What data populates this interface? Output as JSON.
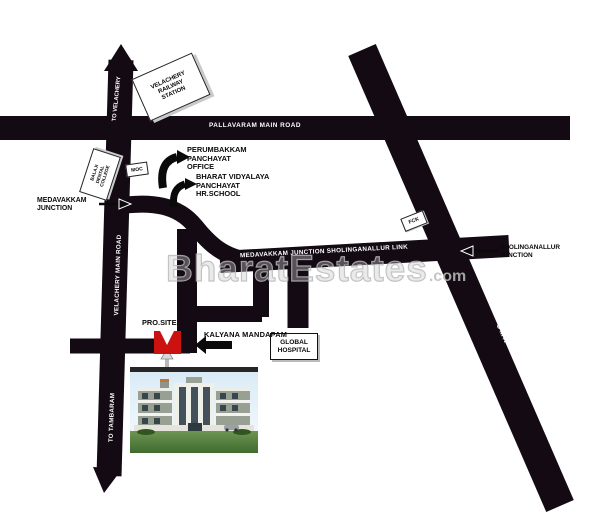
{
  "map": {
    "watermark": {
      "name": "BharatEstates",
      "suffix": ".com"
    },
    "road_labels": {
      "pallavaram": "PALLAVARAM MAIN ROAD",
      "to_velachery": "TO VELACHERY",
      "velachery_main": "VELACHERY MAIN ROAD",
      "to_tambaram": "TO TAMBARAM",
      "link_road": "MEDAVAKKAM JUNCTION SHOLINGANALLUR LINK",
      "omr": "OMR"
    },
    "landmarks": {
      "railway_station": {
        "line1": "VELACHERY",
        "line2": "RAILWAY",
        "line3": "STATION"
      },
      "college": {
        "line1": "BALAJI",
        "line2": "DENTAL",
        "line3": "COLLEGE"
      },
      "moc": "MOC",
      "fck": "FCK",
      "panchayat_office": {
        "line1": "PERUMBAKKAM",
        "line2": "PANCHAYAT",
        "line3": "OFFICE"
      },
      "school": {
        "line1": "BHARAT VIDYALAYA",
        "line2": "PANCHAYAT",
        "line3": "HR.SCHOOL"
      },
      "medavakkam_junction": {
        "line1": "MEDAVAKKAM",
        "line2": "JUNCTION"
      },
      "sholinganallur_junction": {
        "line1": "SHOLINGANALLUR",
        "line2": "JUNCTION"
      },
      "pro_site": "PRO.SITE",
      "kalyana_mandapam": "KALYANA MANDAPAM",
      "global_hospital": {
        "line1": "GLOBAL",
        "line2": "HOSPITAL"
      }
    },
    "colors": {
      "road": "#130a13",
      "site_marker": "#cc1111",
      "watermark": "#bdbdbd"
    }
  }
}
